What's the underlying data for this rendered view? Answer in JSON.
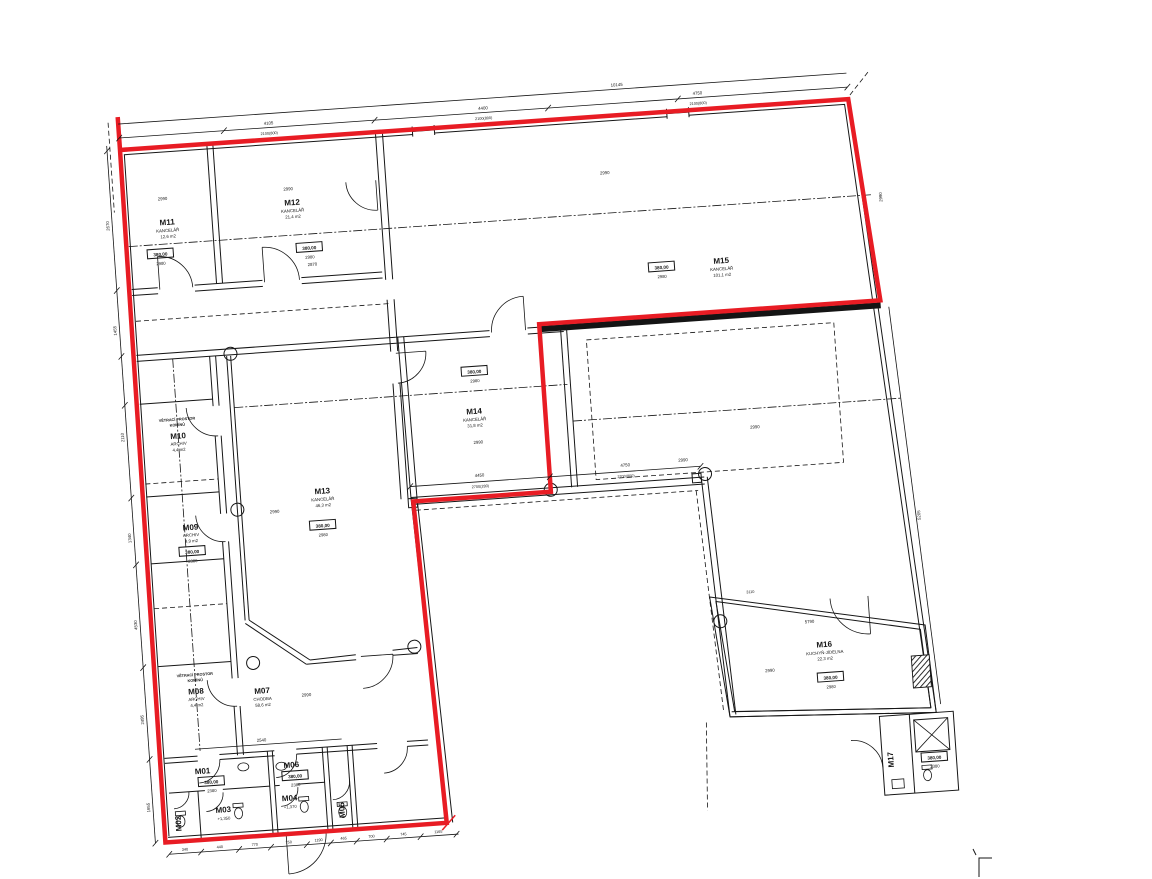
{
  "boundary_color": "#e81c24",
  "rooms": {
    "m01": {
      "id": "M01",
      "level": "380,00",
      "height": "2380"
    },
    "m02": {
      "id": "M02"
    },
    "m03": {
      "id": "M03",
      "note": "+1,350"
    },
    "m04": {
      "id": "M04",
      "note": "+1,370"
    },
    "m05": {
      "id": "M05"
    },
    "m06": {
      "id": "M06",
      "level": "380,00",
      "height": "2380"
    },
    "m07": {
      "id": "M07",
      "type": "CHODBA",
      "area": "58,6 m2",
      "dim": "2990"
    },
    "m08": {
      "id": "M08",
      "type": "ARCHIV",
      "area": "4,4 m2",
      "note1": "VĚTRACÍ PROSTOR",
      "note2": "KOMÍNŮ"
    },
    "m09": {
      "id": "M09",
      "type": "ARCHIV",
      "area": "4,9 m2",
      "level": "380,00",
      "height": "2380"
    },
    "m10": {
      "id": "M10",
      "type": "ARCHIV",
      "area": "4,4 m2",
      "note1": "VĚTRACÍ PROSTOR",
      "note2": "KOMÍNŮ"
    },
    "m11": {
      "id": "M11",
      "type": "KANCELÁŘ",
      "area": "12,6 m2",
      "level": "380,00",
      "height": "2980",
      "dim": "2990"
    },
    "m12": {
      "id": "M12",
      "type": "KANCELÁŘ",
      "area": "21,4 m2",
      "level": "380,00",
      "height": "2980",
      "dim": "2990",
      "dim2": "2870"
    },
    "m13": {
      "id": "M13",
      "type": "KANCELÁŘ",
      "area": "46,3 m2",
      "level": "380,00",
      "height": "2980",
      "dim": "2990"
    },
    "m14": {
      "id": "M14",
      "type": "KANCELÁŘ",
      "area": "31,8 m2",
      "level": "380,00",
      "height": "2980",
      "dim": "2990"
    },
    "m15": {
      "id": "M15",
      "type": "KANCELÁŘ",
      "area": "101,1 m2",
      "level": "380,00",
      "height": "2980",
      "dim": "2990"
    },
    "m16": {
      "id": "M16",
      "type": "KUCHYŇ-JÍDELNA",
      "area": "22,3 m2",
      "level": "380,00",
      "height": "2980",
      "dim": "2990",
      "dim_w": "5790",
      "dim_top": "3110"
    },
    "m17": {
      "id": "M17",
      "level": "380,00",
      "height": "2380"
    }
  },
  "dims": {
    "top_pairs": [
      {
        "v": "4105",
        "s": "2100(800)"
      },
      {
        "v": "4400",
        "s": "2100(800)"
      },
      {
        "v": "4750",
        "s": "2100(800)"
      }
    ],
    "top_total": "10145",
    "mid_pairs": [
      {
        "v": "4450",
        "s": "2700(280)"
      },
      {
        "v": "4750",
        "s": "2700(800)"
      }
    ],
    "mid_end": "2990",
    "wing": "2990",
    "left": [
      "2670",
      "1455",
      "2110",
      "1340",
      "4530",
      "2495",
      "1655"
    ],
    "bottom": [
      "340",
      "440",
      "770",
      "750",
      "1190",
      "465",
      "700",
      "745",
      "1165"
    ],
    "right": [
      "2990",
      "5205"
    ],
    "block_top": "2540"
  }
}
